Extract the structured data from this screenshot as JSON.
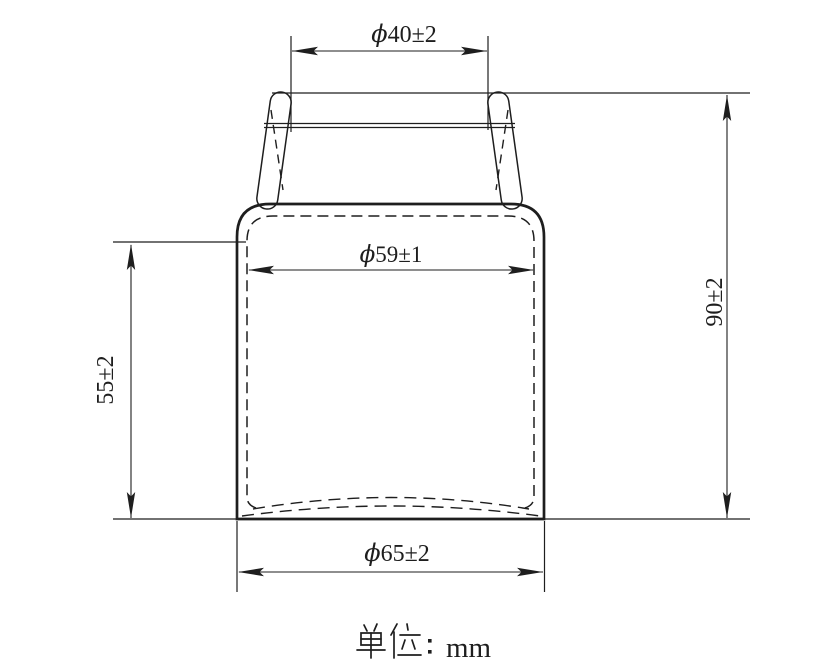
{
  "page": {
    "background": "#ffffff",
    "line_color": "#1e1e1e"
  },
  "drawing": {
    "dimensions": {
      "neck_diameter": {
        "symbol": "ϕ",
        "value": "40±2"
      },
      "inner_diameter": {
        "symbol": "ϕ",
        "value": "59±1"
      },
      "inner_height": {
        "value": "55±2"
      },
      "overall_height": {
        "value": "90±2"
      },
      "outer_diameter": {
        "symbol": "ϕ",
        "value": "65±2"
      }
    },
    "caption": {
      "label": "单位",
      "separator": "：",
      "unit": "mm",
      "full_text": "单位：mm"
    }
  }
}
